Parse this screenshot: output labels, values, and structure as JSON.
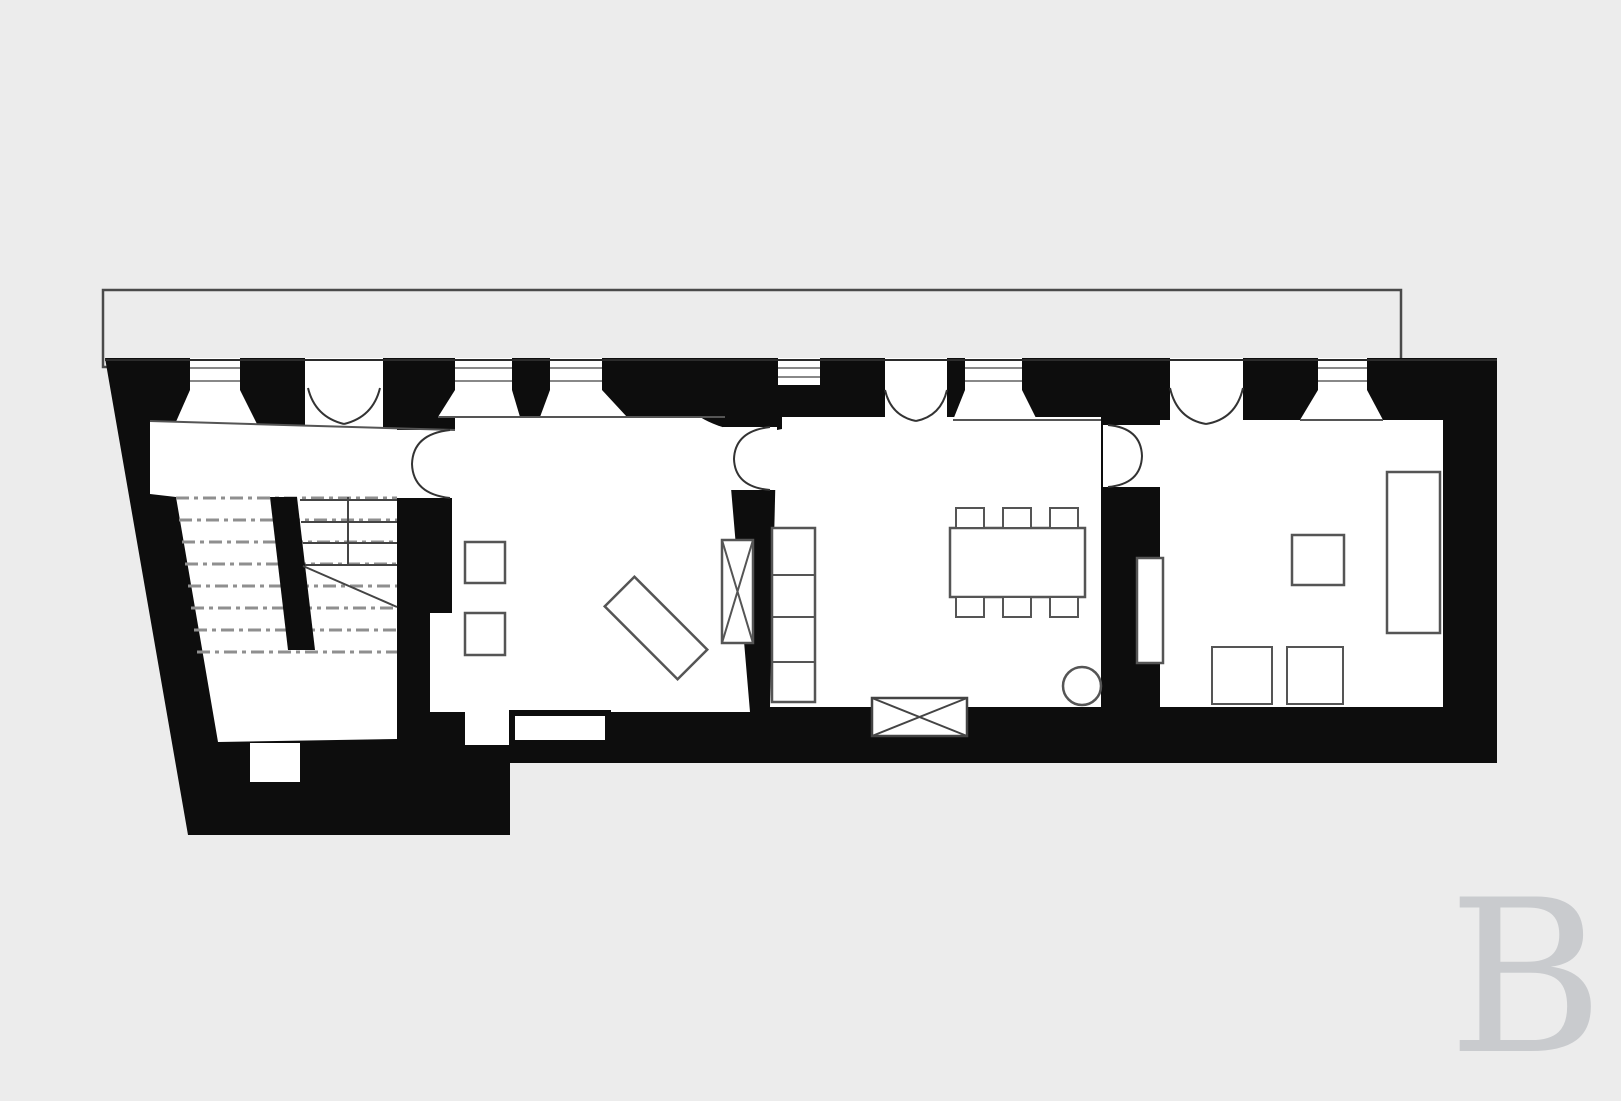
{
  "canvas": {
    "width": 1621,
    "height": 1080,
    "background": "#ececec"
  },
  "colors": {
    "background": "#ececec",
    "wall_ink": "#0d0d0d",
    "room_fill": "#ffffff",
    "furniture_stroke": "#555555",
    "door_arc_stroke": "#333333",
    "stair_dash": "#8f8f8f",
    "terrace_outline": "#4a4a4a",
    "watermark_color": "#c9cbce"
  },
  "watermark": {
    "letter": "B"
  },
  "plan": {
    "shapes": [
      {
        "name": "terrace-outline",
        "type": "rect",
        "x": 103,
        "y": 290,
        "w": 1298,
        "h": 77,
        "fill": "#ececec",
        "stroke": "#4a4a4a",
        "sw": 2.5
      },
      {
        "name": "building-walls",
        "type": "poly",
        "points": "105,358 1497,358 1497,763 510,763 510,835 188,835",
        "fill": "#0d0d0d"
      },
      {
        "name": "room-stair-hall-floor",
        "type": "poly",
        "points": "150,421 455,430 455,498 397,498 397,739 218,742 176,497 150,494",
        "fill": "#ffffff"
      },
      {
        "name": "room-living-floor",
        "type": "poly",
        "points": "455,417 725,417 750,712 430,712 430,613 452,613 452,430 455,430",
        "fill": "#ffffff"
      },
      {
        "name": "room-dining-floor",
        "type": "poly",
        "points": "777,417 1101,417 1101,707 770,707",
        "fill": "#ffffff"
      },
      {
        "name": "room-bedroom-floor",
        "type": "poly",
        "points": "1160,420 1443,420 1443,707 1160,707",
        "fill": "#ffffff"
      },
      {
        "name": "wall-corner-fan",
        "type": "path",
        "d": "M 700,412 L 782,412 L 782,429 A 85,60 0 0 1 700,417 Z",
        "fill": "#0d0d0d"
      },
      {
        "name": "wall-above-hall-door",
        "type": "rect",
        "x": 397,
        "y": 417,
        "w": 58,
        "h": 13,
        "fill": "#0d0d0d"
      },
      {
        "name": "door-gap-living-dining",
        "type": "rect",
        "x": 723,
        "y": 427,
        "w": 54,
        "h": 63,
        "fill": "#ffffff"
      },
      {
        "name": "door-gap-dining-bedroom",
        "type": "rect",
        "x": 1103,
        "y": 425,
        "w": 57,
        "h": 62,
        "fill": "#ffffff"
      },
      {
        "name": "window-slot-1",
        "type": "rect",
        "x": 190,
        "y": 358,
        "w": 50,
        "h": 32,
        "fill": "#ffffff"
      },
      {
        "name": "window-splay-1",
        "type": "poly",
        "points": "190,390 240,390 257,424 175,424",
        "fill": "#ffffff"
      },
      {
        "name": "window-slot-2",
        "type": "rect",
        "x": 455,
        "y": 358,
        "w": 57,
        "h": 32,
        "fill": "#ffffff"
      },
      {
        "name": "window-splay-2",
        "type": "poly",
        "points": "455,390 512,390 520,417 438,417",
        "fill": "#ffffff"
      },
      {
        "name": "window-slot-3",
        "type": "rect",
        "x": 550,
        "y": 358,
        "w": 52,
        "h": 32,
        "fill": "#ffffff"
      },
      {
        "name": "window-splay-3",
        "type": "poly",
        "points": "550,390 602,390 627,417 540,417",
        "fill": "#ffffff"
      },
      {
        "name": "window-slot-4",
        "type": "rect",
        "x": 778,
        "y": 358,
        "w": 42,
        "h": 27,
        "fill": "#ffffff"
      },
      {
        "name": "window-slot-5",
        "type": "rect",
        "x": 965,
        "y": 358,
        "w": 57,
        "h": 32,
        "fill": "#ffffff"
      },
      {
        "name": "window-splay-5",
        "type": "poly",
        "points": "965,390 1022,390 1037,420 953,420",
        "fill": "#ffffff"
      },
      {
        "name": "window-slot-6",
        "type": "rect",
        "x": 1318,
        "y": 358,
        "w": 49,
        "h": 32,
        "fill": "#ffffff"
      },
      {
        "name": "window-splay-6",
        "type": "poly",
        "points": "1318,390 1367,390 1383,420 1300,420",
        "fill": "#ffffff"
      },
      {
        "name": "door-gap-entrance",
        "type": "rect",
        "x": 305,
        "y": 358,
        "w": 78,
        "h": 70,
        "fill": "#ffffff"
      },
      {
        "name": "door-gap-dining-terrace",
        "type": "rect",
        "x": 885,
        "y": 358,
        "w": 62,
        "h": 62,
        "fill": "#ffffff"
      },
      {
        "name": "door-gap-bedroom-terrace",
        "type": "rect",
        "x": 1170,
        "y": 358,
        "w": 73,
        "h": 66,
        "fill": "#ffffff"
      },
      {
        "name": "facade-outer-edge-line",
        "type": "line",
        "x1": 105,
        "y1": 360,
        "x2": 1497,
        "y2": 360,
        "stroke": "#2b2b2b",
        "sw": 2
      },
      {
        "name": "glazing-line",
        "type": "line",
        "x1": 190,
        "y1": 368,
        "x2": 240,
        "y2": 368,
        "stroke": "#777777",
        "sw": 1.8
      },
      {
        "name": "glazing-line",
        "type": "line",
        "x1": 190,
        "y1": 381,
        "x2": 240,
        "y2": 381,
        "stroke": "#777777",
        "sw": 1.8
      },
      {
        "name": "glazing-line",
        "type": "line",
        "x1": 455,
        "y1": 368,
        "x2": 512,
        "y2": 368,
        "stroke": "#777777",
        "sw": 1.8
      },
      {
        "name": "glazing-line",
        "type": "line",
        "x1": 455,
        "y1": 381,
        "x2": 512,
        "y2": 381,
        "stroke": "#777777",
        "sw": 1.8
      },
      {
        "name": "glazing-line",
        "type": "line",
        "x1": 550,
        "y1": 368,
        "x2": 602,
        "y2": 368,
        "stroke": "#777777",
        "sw": 1.8
      },
      {
        "name": "glazing-line",
        "type": "line",
        "x1": 550,
        "y1": 381,
        "x2": 602,
        "y2": 381,
        "stroke": "#777777",
        "sw": 1.8
      },
      {
        "name": "glazing-line",
        "type": "line",
        "x1": 778,
        "y1": 368,
        "x2": 820,
        "y2": 368,
        "stroke": "#777777",
        "sw": 1.8
      },
      {
        "name": "glazing-line",
        "type": "line",
        "x1": 778,
        "y1": 377,
        "x2": 820,
        "y2": 377,
        "stroke": "#777777",
        "sw": 1.8
      },
      {
        "name": "glazing-line",
        "type": "line",
        "x1": 965,
        "y1": 368,
        "x2": 1022,
        "y2": 368,
        "stroke": "#777777",
        "sw": 1.8
      },
      {
        "name": "glazing-line",
        "type": "line",
        "x1": 965,
        "y1": 381,
        "x2": 1022,
        "y2": 381,
        "stroke": "#777777",
        "sw": 1.8
      },
      {
        "name": "glazing-line",
        "type": "line",
        "x1": 1318,
        "y1": 368,
        "x2": 1367,
        "y2": 368,
        "stroke": "#777777",
        "sw": 1.8
      },
      {
        "name": "glazing-line",
        "type": "line",
        "x1": 1318,
        "y1": 381,
        "x2": 1367,
        "y2": 381,
        "stroke": "#777777",
        "sw": 1.8
      },
      {
        "name": "hall-interior-face-line",
        "type": "line",
        "x1": 150,
        "y1": 421,
        "x2": 455,
        "y2": 430,
        "stroke": "#555555",
        "sw": 2
      },
      {
        "name": "living-interior-face-line",
        "type": "line",
        "x1": 438,
        "y1": 417,
        "x2": 725,
        "y2": 417,
        "stroke": "#555555",
        "sw": 2
      },
      {
        "name": "dining-interior-face-line",
        "type": "line",
        "x1": 953,
        "y1": 420,
        "x2": 1101,
        "y2": 420,
        "stroke": "#555555",
        "sw": 2
      },
      {
        "name": "bedroom-interior-face-line",
        "type": "line",
        "x1": 1300,
        "y1": 420,
        "x2": 1383,
        "y2": 420,
        "stroke": "#555555",
        "sw": 2
      },
      {
        "name": "stair-dashed-line",
        "type": "line",
        "x1": 176,
        "y1": 498,
        "x2": 397,
        "y2": 498,
        "stroke": "#8f8f8f",
        "sw": 3,
        "dash": "13 5 4 5"
      },
      {
        "name": "stair-dashed-line",
        "type": "line",
        "x1": 179,
        "y1": 520,
        "x2": 397,
        "y2": 520,
        "stroke": "#8f8f8f",
        "sw": 3,
        "dash": "13 5 4 5"
      },
      {
        "name": "stair-dashed-line",
        "type": "line",
        "x1": 182,
        "y1": 542,
        "x2": 397,
        "y2": 542,
        "stroke": "#8f8f8f",
        "sw": 3,
        "dash": "13 5 4 5"
      },
      {
        "name": "stair-dashed-line",
        "type": "line",
        "x1": 185,
        "y1": 564,
        "x2": 397,
        "y2": 564,
        "stroke": "#8f8f8f",
        "sw": 3,
        "dash": "13 5 4 5"
      },
      {
        "name": "stair-dashed-line",
        "type": "line",
        "x1": 188,
        "y1": 586,
        "x2": 397,
        "y2": 586,
        "stroke": "#8f8f8f",
        "sw": 3,
        "dash": "13 5 4 5"
      },
      {
        "name": "stair-dashed-line",
        "type": "line",
        "x1": 191,
        "y1": 608,
        "x2": 397,
        "y2": 608,
        "stroke": "#8f8f8f",
        "sw": 3,
        "dash": "13 5 4 5"
      },
      {
        "name": "stair-dashed-line",
        "type": "line",
        "x1": 194,
        "y1": 630,
        "x2": 397,
        "y2": 630,
        "stroke": "#8f8f8f",
        "sw": 3,
        "dash": "13 5 4 5"
      },
      {
        "name": "stair-dashed-line",
        "type": "line",
        "x1": 197,
        "y1": 652,
        "x2": 397,
        "y2": 652,
        "stroke": "#8f8f8f",
        "sw": 3,
        "dash": "13 5 4 5"
      },
      {
        "name": "stair-tread-line",
        "type": "line",
        "x1": 300,
        "y1": 500,
        "x2": 397,
        "y2": 500,
        "stroke": "#444444",
        "sw": 2
      },
      {
        "name": "stair-tread-line",
        "type": "line",
        "x1": 301,
        "y1": 522,
        "x2": 397,
        "y2": 522,
        "stroke": "#444444",
        "sw": 2
      },
      {
        "name": "stair-tread-line",
        "type": "line",
        "x1": 303,
        "y1": 543,
        "x2": 397,
        "y2": 543,
        "stroke": "#444444",
        "sw": 2
      },
      {
        "name": "stair-tread-line",
        "type": "line",
        "x1": 305,
        "y1": 565,
        "x2": 397,
        "y2": 565,
        "stroke": "#444444",
        "sw": 2
      },
      {
        "name": "stair-riser-line",
        "type": "line",
        "x1": 348,
        "y1": 497,
        "x2": 348,
        "y2": 565,
        "stroke": "#444444",
        "sw": 2
      },
      {
        "name": "stair-center-wall",
        "type": "poly",
        "points": "270,497 297,497 315,650 288,650",
        "fill": "#0d0d0d"
      },
      {
        "name": "stair-break-line",
        "type": "line",
        "x1": 303,
        "y1": 566,
        "x2": 397,
        "y2": 607,
        "stroke": "#444444",
        "sw": 2
      },
      {
        "name": "bottom-wall-opening",
        "type": "rect",
        "x": 465,
        "y": 712,
        "w": 145,
        "h": 33,
        "fill": "#ffffff"
      },
      {
        "name": "bench-sideboard",
        "type": "rect",
        "x": 512,
        "y": 713,
        "w": 96,
        "h": 30,
        "fill": "#ffffff",
        "stroke": "#0d0d0d",
        "sw": 6
      },
      {
        "name": "hall-wall-niche",
        "type": "rect",
        "x": 250,
        "y": 743,
        "w": 50,
        "h": 39,
        "fill": "#ffffff"
      },
      {
        "name": "living-side-table-1",
        "type": "rect",
        "x": 465,
        "y": 542,
        "w": 40,
        "h": 41,
        "fill": "#ffffff",
        "stroke": "#555555",
        "sw": 2.5
      },
      {
        "name": "living-side-table-2",
        "type": "rect",
        "x": 465,
        "y": 613,
        "w": 40,
        "h": 42,
        "fill": "#ffffff",
        "stroke": "#555555",
        "sw": 2.5
      },
      {
        "name": "living-sofa-diagonal",
        "type": "rect",
        "x": -51.5,
        "y": -21,
        "w": 103,
        "h": 42,
        "fill": "#ffffff",
        "stroke": "#555555",
        "sw": 2.5,
        "transform": "translate(656,628) rotate(45)"
      },
      {
        "name": "living-flue-box",
        "type": "rect",
        "x": 722,
        "y": 540,
        "w": 31,
        "h": 103,
        "fill": "#ffffff",
        "stroke": "#555555",
        "sw": 2.5
      },
      {
        "name": "living-flue-cross",
        "type": "path",
        "d": "M 722,540 L 753,643 M 753,540 L 722,643",
        "stroke": "#555555",
        "sw": 2,
        "fill": "none"
      },
      {
        "name": "dining-cabinet-column",
        "type": "rect",
        "x": 772,
        "y": 528,
        "w": 43,
        "h": 174,
        "fill": "#ffffff",
        "stroke": "#555555",
        "sw": 2.5
      },
      {
        "name": "dining-cabinet-divider",
        "type": "line",
        "x1": 772,
        "y1": 575,
        "x2": 815,
        "y2": 575,
        "stroke": "#555555",
        "sw": 2
      },
      {
        "name": "dining-cabinet-divider",
        "type": "line",
        "x1": 772,
        "y1": 617,
        "x2": 815,
        "y2": 617,
        "stroke": "#555555",
        "sw": 2
      },
      {
        "name": "dining-cabinet-divider",
        "type": "line",
        "x1": 772,
        "y1": 662,
        "x2": 815,
        "y2": 662,
        "stroke": "#555555",
        "sw": 2
      },
      {
        "name": "dining-table",
        "type": "rect",
        "x": 950,
        "y": 528,
        "w": 135,
        "h": 69,
        "fill": "#ffffff",
        "stroke": "#555555",
        "sw": 2.5
      },
      {
        "name": "dining-chair",
        "type": "rect",
        "x": 956,
        "y": 508,
        "w": 28,
        "h": 20,
        "fill": "#ffffff",
        "stroke": "#555555",
        "sw": 2
      },
      {
        "name": "dining-chair",
        "type": "rect",
        "x": 1003,
        "y": 508,
        "w": 28,
        "h": 20,
        "fill": "#ffffff",
        "stroke": "#555555",
        "sw": 2
      },
      {
        "name": "dining-chair",
        "type": "rect",
        "x": 1050,
        "y": 508,
        "w": 28,
        "h": 20,
        "fill": "#ffffff",
        "stroke": "#555555",
        "sw": 2
      },
      {
        "name": "dining-chair",
        "type": "rect",
        "x": 956,
        "y": 597,
        "w": 28,
        "h": 20,
        "fill": "#ffffff",
        "stroke": "#555555",
        "sw": 2
      },
      {
        "name": "dining-chair",
        "type": "rect",
        "x": 1003,
        "y": 597,
        "w": 28,
        "h": 20,
        "fill": "#ffffff",
        "stroke": "#555555",
        "sw": 2
      },
      {
        "name": "dining-chair",
        "type": "rect",
        "x": 1050,
        "y": 597,
        "w": 28,
        "h": 20,
        "fill": "#ffffff",
        "stroke": "#555555",
        "sw": 2
      },
      {
        "name": "dining-stove-circle",
        "type": "circle",
        "cx": 1082,
        "cy": 686,
        "r": 19,
        "fill": "#ffffff",
        "stroke": "#555555",
        "sw": 2.5
      },
      {
        "name": "dining-crate-box",
        "type": "rect",
        "x": 872,
        "y": 698,
        "w": 95,
        "h": 38,
        "fill": "#ffffff",
        "stroke": "#444444",
        "sw": 2.5
      },
      {
        "name": "dining-crate-cross",
        "type": "path",
        "d": "M 872,698 L 967,736 M 967,698 L 872,736",
        "stroke": "#444444",
        "sw": 2,
        "fill": "none"
      },
      {
        "name": "bedroom-bed",
        "type": "rect",
        "x": 1387,
        "y": 472,
        "w": 53,
        "h": 161,
        "fill": "#ffffff",
        "stroke": "#555555",
        "sw": 2.5
      },
      {
        "name": "bedroom-table-square",
        "type": "rect",
        "x": 1292,
        "y": 535,
        "w": 52,
        "h": 50,
        "fill": "#ffffff",
        "stroke": "#555555",
        "sw": 2.5
      },
      {
        "name": "bedroom-seat-1",
        "type": "rect",
        "x": 1212,
        "y": 647,
        "w": 60,
        "h": 57,
        "fill": "#ffffff",
        "stroke": "#555555",
        "sw": 2
      },
      {
        "name": "bedroom-seat-2",
        "type": "rect",
        "x": 1287,
        "y": 647,
        "w": 56,
        "h": 57,
        "fill": "#ffffff",
        "stroke": "#555555",
        "sw": 2
      },
      {
        "name": "bedroom-radiator",
        "type": "rect",
        "x": 1137,
        "y": 558,
        "w": 26,
        "h": 105,
        "fill": "#ffffff",
        "stroke": "#555555",
        "sw": 2.5
      },
      {
        "name": "door-swing-entrance",
        "type": "path",
        "d": "M 308,388 Q 315,417 344,424 M 380,388 Q 373,417 344,424",
        "stroke": "#333333",
        "sw": 2,
        "fill": "none"
      },
      {
        "name": "door-swing-dining-terrace",
        "type": "path",
        "d": "M 885,390 Q 891,416 916,421 M 947,390 Q 941,416 916,421",
        "stroke": "#333333",
        "sw": 2,
        "fill": "none"
      },
      {
        "name": "door-swing-bedroom-terrace",
        "type": "path",
        "d": "M 1170,388 Q 1177,419 1206,424 M 1243,388 Q 1236,419 1206,424",
        "stroke": "#333333",
        "sw": 2,
        "fill": "none"
      },
      {
        "name": "door-swing-hall-living",
        "type": "path",
        "d": "M 450,430 Q 413,434 412,464 Q 413,494 450,498",
        "stroke": "#333333",
        "sw": 2,
        "fill": "none"
      },
      {
        "name": "door-swing-living-dining",
        "type": "path",
        "d": "M 770,427 Q 735,431 734,459 Q 735,487 770,490",
        "stroke": "#333333",
        "sw": 2,
        "fill": "none"
      },
      {
        "name": "door-swing-dining-bedroom",
        "type": "path",
        "d": "M 1108,425 Q 1141,428 1142,456 Q 1141,484 1108,487",
        "stroke": "#333333",
        "sw": 2,
        "fill": "none"
      }
    ]
  }
}
